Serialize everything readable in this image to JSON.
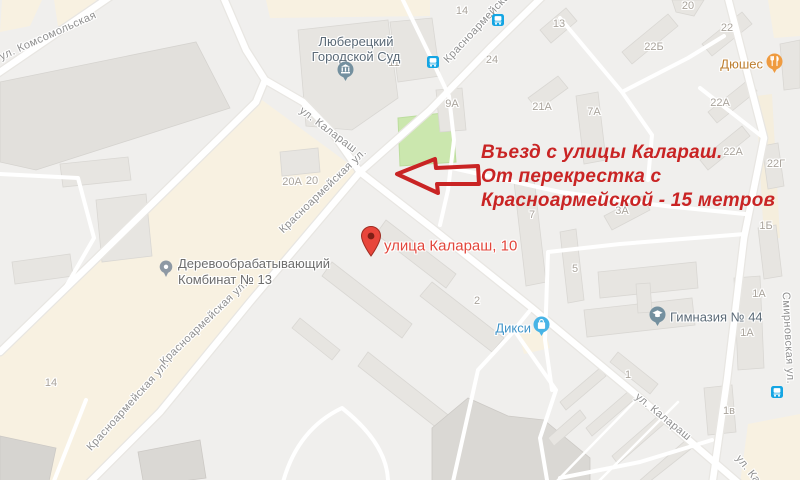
{
  "colors": {
    "annotation_red": "#c92424",
    "marker_red": "#e8463b",
    "transit_blue": "#14a5e3",
    "poi_civic_gray_blue": "#5b6a77",
    "poi_food_orange": "#bd7e2f",
    "poi_shop_blue": "#3e93c8",
    "street_label_gray": "#8f8f8f",
    "building_label_gray": "#a9a39b",
    "park_green": "#cbe7ae",
    "commercial_cream": "#f8f1e1",
    "road_white": "#ffffff"
  },
  "annotation": {
    "line1": "Въезд с улицы Калараш.",
    "line2": "От перекрестка с",
    "line3": "Красноармейской - 15 метров"
  },
  "marker": {
    "label": "улица Калараш, 10"
  },
  "pois": {
    "court": {
      "line1": "Люберецкий",
      "line2": "Городской Суд"
    },
    "dushes": {
      "name": "Дюшес"
    },
    "dixy": {
      "name": "Дикси"
    },
    "gymnasium": {
      "name": "Гимназия № 44"
    },
    "plant": {
      "line1": "Деревообрабатывающий",
      "line2": "Комбинат № 13"
    }
  },
  "streets": {
    "komsomolskaya": "ул. Комсомольская",
    "krasnoarmeyskaya": "Красноармейская",
    "krasnoarmeyskaya_ul": "Красноармейская ул.",
    "kalarash": "ул. Калараш",
    "kalarash_short": "ул. Кал",
    "smirnovskaya": "Смирновская ул."
  },
  "buildings": [
    "14",
    "13",
    "20",
    "22",
    "22Б",
    "9А",
    "21А",
    "7А",
    "24",
    "22А",
    "22А",
    "22Г",
    "20А",
    "20",
    "11",
    "7",
    "3А",
    "1Б",
    "5",
    "1А",
    "1А",
    "1в",
    "2",
    "1",
    "14"
  ]
}
